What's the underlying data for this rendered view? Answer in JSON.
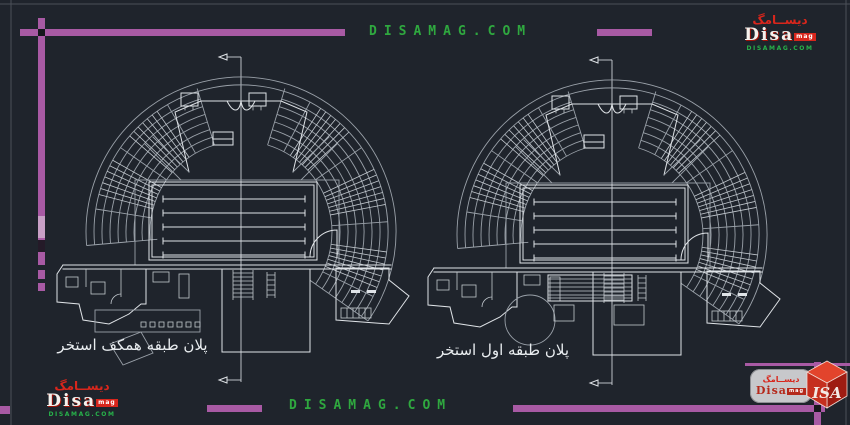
{
  "watermarks": {
    "top_text": "DISAMAG.COM",
    "bottom_text": "DISAMAG.COM"
  },
  "logos": {
    "script": "ديســامگ",
    "name": "Disa",
    "name_suffix": "mag",
    "site": "DISAMAG.COM",
    "cube_text": "ISA"
  },
  "plans": [
    {
      "caption": "پلان طبقه همکف استخر"
    },
    {
      "caption": "پلان طبقه اول استخر"
    }
  ],
  "colors": {
    "background": "#1f242c",
    "frame_magenta": "#a85aa4",
    "watermark_green": "#2fa83f",
    "drawing_white": "#dfe3e7",
    "drawing_dim": "#9aa1a9",
    "logo_red": "#d8261c",
    "pill_gray": "#c7c8cb"
  }
}
